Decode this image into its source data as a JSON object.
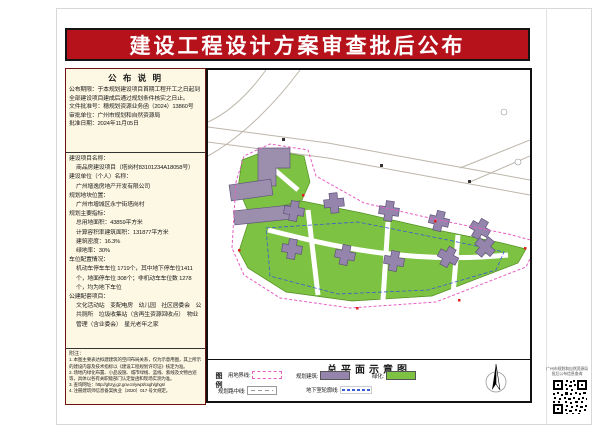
{
  "banner": {
    "title": "建设工程设计方案审查批后公布",
    "bg_color": "#b5121b"
  },
  "notice": {
    "header": "公 布 说 明",
    "period": "公布期限：于本规划建设项目首期工程开工之日起到全部建设项目建成后通过规划条件核实之日止。",
    "doc_no": "文件批准号：穗规划资源业务函（2024）13860号",
    "authority": "审批单位：广州市规划和自然资源局",
    "date": "批准日期：2024年11月05日"
  },
  "project": {
    "name_label": "建设项目名称：",
    "name": "商品房建设项目（塔岗村83101234A18058号）",
    "owner_label": "建设单位（个人）名称：",
    "owner": "广州增逸房地产开发有限公司",
    "location_label": "规划地块位置：",
    "location": "广州市增城区永宁街塔岗村",
    "indicators_label": "规划主要指标：",
    "indicators": [
      "总用地面积：43859平方米",
      "计算容积率建筑面积：131877平方米",
      "建筑密度：16.3%",
      "绿地率：30%"
    ],
    "parking_label": "车位配置情况：",
    "parking": "机动车停车车位 1719个，其中地下停车位1411个，地面停车位 308个；非机动车车位数 1278个，均为地下车位",
    "facilities_label": "公建配套项目：",
    "facilities": "文化活动站　变配电房　幼儿园　社区居委会　公共厕所　垃圾收集站（含再生资源回收点）　物业管理（含业委会）　星光老年之家"
  },
  "notes": {
    "label": "附注：",
    "items": [
      "1. 本图主要表达拟建建筑的空间布局关系，仅为示意用图，其上所示的建设内容及技术指标以《建设工程规划许可证》核定为准。",
      "2. 场地内绿化布置、小品设施、城市绿线、蓝线、紫线及文物古迹等，具体以各有关职能部门认定复函和现场实测为准。",
      "3. 查询网址：http://ghzyj.gz.gov.cn/ywpt/cxgh/ghgs/",
      "4. 注册建筑师信息备案执业〔2020〕017 号文规定。"
    ]
  },
  "plan": {
    "title": "总平面示意图",
    "legend_label": "图例",
    "legend": [
      {
        "label": "用地界线:"
      },
      {
        "label": "规划建筑:"
      },
      {
        "label": "绿化:"
      },
      {
        "label": "规划路中线:"
      },
      {
        "label": "地下室轮廓线:"
      }
    ],
    "colors": {
      "building": "#9585ad",
      "greenery": "#7dc242",
      "boundary": "#e75fc3",
      "underground_line": "#3a5fd0"
    }
  },
  "qr": {
    "caption_line1": "广州市规划和自然资源局",
    "caption_line2": "批后公布信息查询"
  }
}
